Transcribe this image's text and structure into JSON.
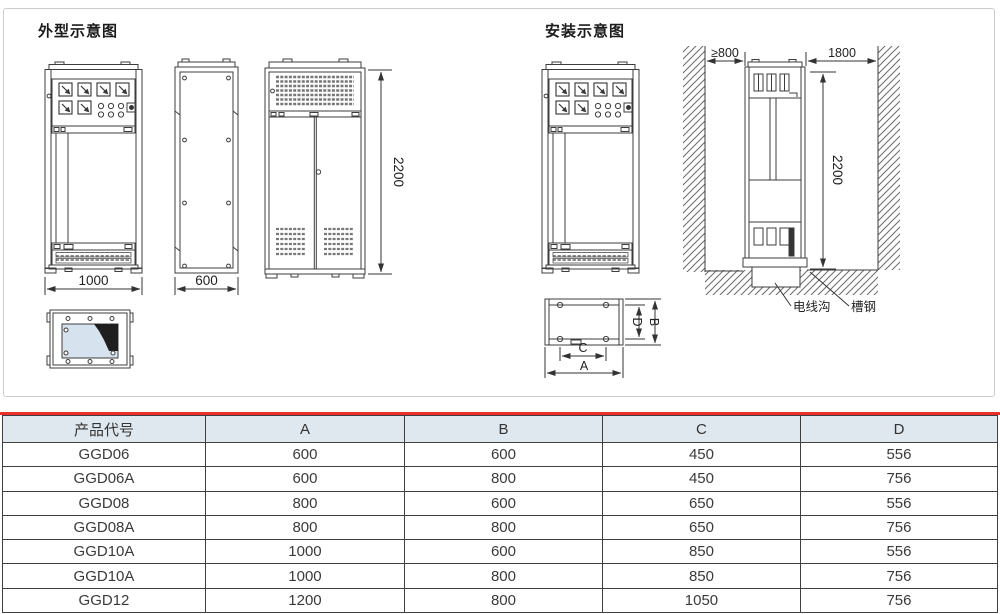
{
  "titles": {
    "outline": "外型示意图",
    "install": "安装示意图"
  },
  "outline_view": {
    "front_width": "1000",
    "side_depth": "600",
    "height": "2200"
  },
  "install_view": {
    "min_wall_clearance": "≥800",
    "rear_clearance": "1800",
    "height": "2200",
    "cable_trench_label": "电线沟",
    "channel_steel_label": "槽钢",
    "base_dim_a": "A",
    "base_dim_b": "B",
    "base_dim_c": "C",
    "base_dim_d": "D"
  },
  "colors": {
    "accent_red": "#e8322b",
    "table_header_bg": "#dfe8ef",
    "drawing_line": "#3d3d3d",
    "window_fill": "#d6e3ee"
  },
  "table": {
    "headers": [
      "产品代号",
      "A",
      "B",
      "C",
      "D"
    ],
    "rows": [
      [
        "GGD06",
        "600",
        "600",
        "450",
        "556"
      ],
      [
        "GGD06A",
        "600",
        "800",
        "450",
        "756"
      ],
      [
        "GGD08",
        "800",
        "600",
        "650",
        "556"
      ],
      [
        "GGD08A",
        "800",
        "800",
        "650",
        "756"
      ],
      [
        "GGD10A",
        "1000",
        "600",
        "850",
        "556"
      ],
      [
        "GGD10A",
        "1000",
        "800",
        "850",
        "756"
      ],
      [
        "GGD12",
        "1200",
        "800",
        "1050",
        "756"
      ]
    ]
  }
}
